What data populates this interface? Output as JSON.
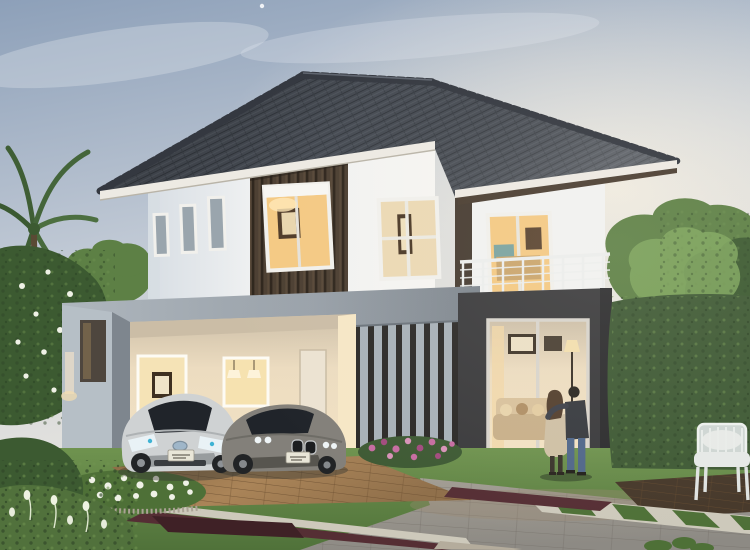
{
  "meta": {
    "description": "Dusk architectural rendering of a modern two-storey detached house with dark grey hip tile roof, white render walls, dark timber slat accents, open double carport with two parked cars, charcoal-framed ground floor glass lounge, upper balcony with white cable railing, landscaped garden and driveway, and a couple standing on the lawn looking at the home.",
    "scene_type": "3d-architectural-visualization",
    "time_of_day": "early evening"
  },
  "scene": {
    "house": {
      "storeys": 2,
      "roof": "dark grey concrete tile hip roof with ridge caps",
      "walls": "white render with vertical dark timber slat feature panels",
      "upper_windows": 4,
      "balcony": "upper right with white posts and cable railing",
      "ground_feature": "charcoal portal frame with full-height glazed lounge doors",
      "carport_bays": 2,
      "interior_lighting": "warm lights on in all rooms"
    },
    "vehicles": [
      {
        "label": "silver hybrid hatchback",
        "position": "left carport bay"
      },
      {
        "label": "grey sedan",
        "position": "right carport bay"
      }
    ],
    "people": [
      {
        "label": "woman in beige coat"
      },
      {
        "label": "man in dark jacket and jeans, arm around woman"
      }
    ],
    "landscape": [
      "palm fronds top left",
      "white frangipani tree",
      "white flower bed",
      "pink flower bed below louvre screen",
      "clipped hedge wall right",
      "large leafy trees",
      "lawn",
      "grey paver driveway",
      "dark red brick border strips",
      "timber carport apron",
      "timber deck with white garden armchair",
      "stone and grass stepper band"
    ]
  },
  "palette": {
    "roof_tile_base": "#454a52",
    "roof_tile_dark": "#2f343a",
    "roof_tile_light": "#5a6068",
    "fascia": "#edeae3",
    "soffit": "#4a3d31",
    "wall_white": "#f2f2f1",
    "wall_shade": "#d6dce2",
    "pillar_brown": "#463b31",
    "wood_panel": "#4b3e31",
    "wood_slat_dark": "#32291f",
    "window_frame": "#f1f0ec",
    "glass_cool": "#9aa5ad",
    "glass_dark": "#20242a",
    "glow_warm": "#f4c983",
    "glow_soft": "#ecd9b4",
    "interior_wall": "#e7d9bf",
    "interior_ceiling": "#cbbda6",
    "charcoal": "#3b3b3d",
    "beam_gray": "#9ba3ab",
    "beam_gray_dark": "#7e868e",
    "louver_slat": "#a8b1b8",
    "louver_gap": "#2c2a28",
    "railing_white": "#eceeed",
    "lawn": "#6d9150",
    "lawn_dark": "#4e7037",
    "hedge": "#3f5a35",
    "tree_mid": "#5d8045",
    "tree_light": "#7da55c",
    "tree_dark": "#3c5a31",
    "driveway": "#98948c",
    "driveway_dark": "#6e6a64",
    "paver_line": "#55524d",
    "wood_floor": "#a07c52",
    "wood_floor_dark": "#7c5c3c",
    "maroon": "#552e34",
    "maroon_dark": "#3f2126",
    "stone_strip": "#cdc9bb",
    "deck_brown": "#46382a",
    "gravel": "#b4ac9c",
    "flower_white": "#eff1e6",
    "flower_pink": "#c66da1",
    "flower_pink_dark": "#a34b7f",
    "car_silver": "#cfd2d3",
    "car_silver_dark": "#989c9e",
    "car_gray": "#83807a",
    "car_gray_dark": "#57554f",
    "tire": "#222426",
    "plate": "#e9e6d8",
    "skin": "#c89a7e",
    "woman_coat": "#cfc0a5",
    "woman_hair": "#54402f",
    "woman_legs": "#3a342c",
    "man_jacket": "#383b40",
    "man_jeans": "#50678a",
    "man_hair": "#2c2822",
    "chair_white": "#e6e9e7",
    "step_concrete": "#d3d0c7",
    "moon": "#ffffff"
  }
}
